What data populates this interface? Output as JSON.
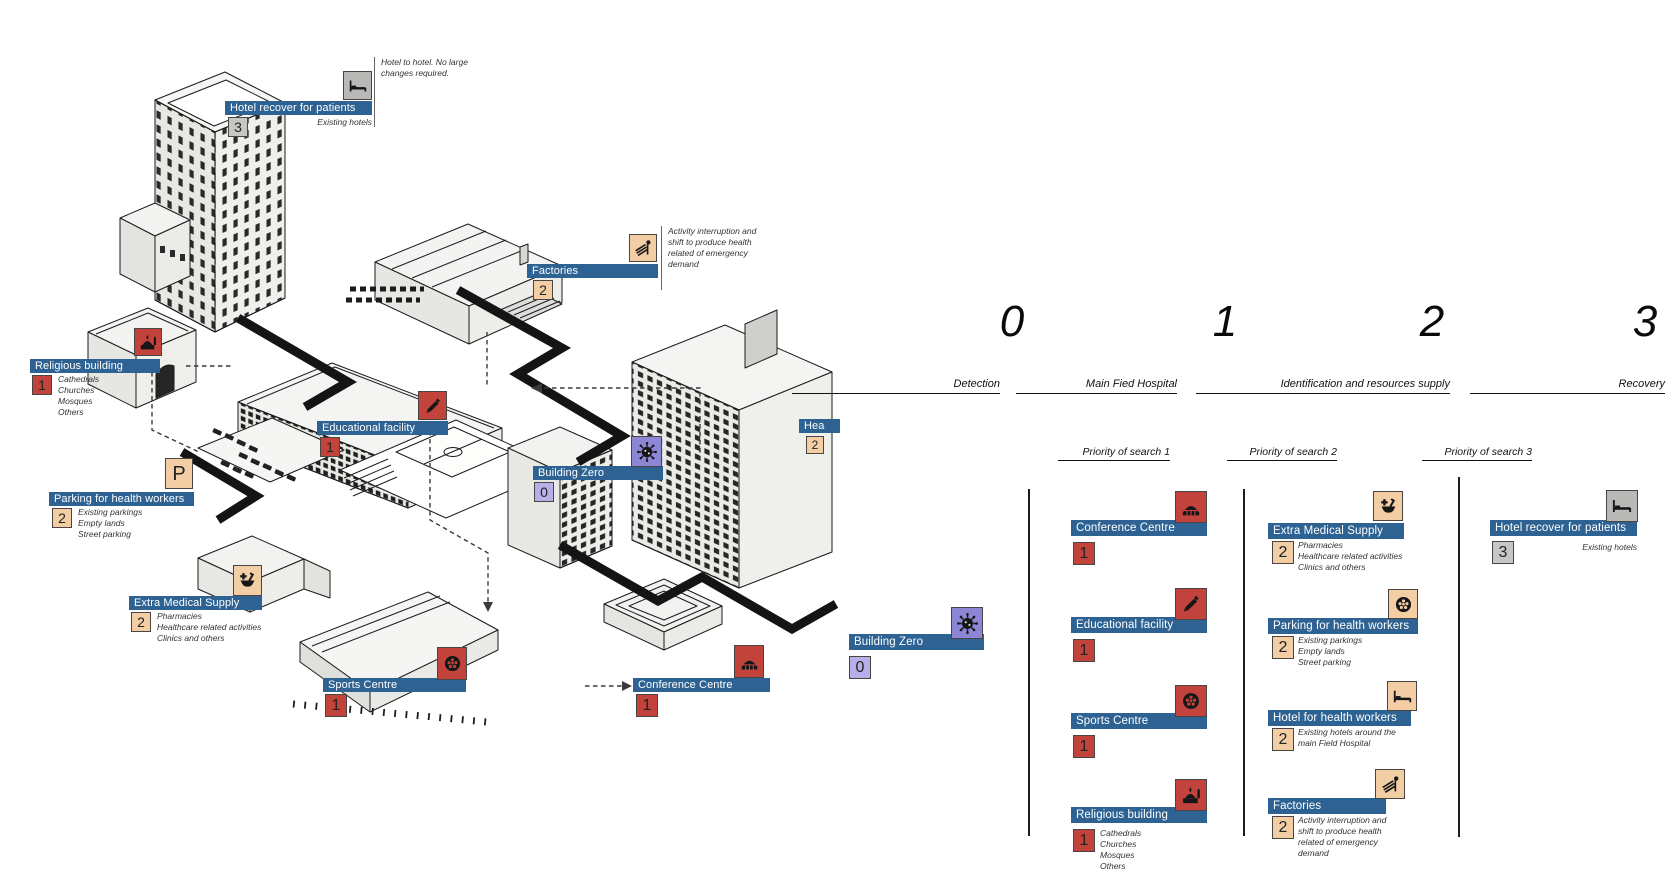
{
  "colors": {
    "bar_blue": "#2d6292",
    "red": "#c2423c",
    "tan": "#f3cda4",
    "purple": "#8d85d6",
    "purple_light": "#b7b0e8",
    "gray": "#b9b9b7"
  },
  "map": {
    "labels": [
      {
        "label": "Hotel recover for patients",
        "badge": "3",
        "icon": "bed-icon",
        "note": "Hotel to hotel. No large changes required.",
        "sub": [
          "Existing hotels"
        ]
      },
      {
        "label": "Factories",
        "badge": "2",
        "icon": "factory-icon",
        "note": "Activity interruption and shift to produce health related  of emergency demand"
      },
      {
        "label": "Religious building",
        "badge": "1",
        "icon": "religious-icon",
        "sub": [
          "Cathedrals",
          "Churches",
          "Mosques",
          "Others"
        ]
      },
      {
        "label": "Educational facility",
        "badge": "1",
        "icon": "education-icon"
      },
      {
        "label": "Building Zero",
        "badge": "0",
        "icon": "virus-icon"
      },
      {
        "label": "Parking for health workers",
        "badge": "2",
        "icon": "parking-icon",
        "icon_letter": "P",
        "sub": [
          "Existing parkings",
          "Empty lands",
          "Street parking"
        ]
      },
      {
        "label": "Extra Medical Supply",
        "badge": "2",
        "icon": "pharmacy-icon",
        "sub": [
          "Pharmacies",
          "Healthcare related activities",
          "Clinics and others"
        ]
      },
      {
        "label": "Sports Centre",
        "badge": "1",
        "icon": "ball-icon"
      },
      {
        "label": "Conference Centre",
        "badge": "1",
        "icon": "conference-icon"
      },
      {
        "label": "Hea",
        "badge": "2"
      }
    ]
  },
  "timeline": {
    "phases": [
      {
        "number": "0",
        "name": "Detection"
      },
      {
        "number": "1",
        "name": "Main Fied Hospital"
      },
      {
        "number": "2",
        "name": "Identification and resources supply"
      },
      {
        "number": "3",
        "name": "Recovery"
      }
    ],
    "priorities": [
      "Priority of search 1",
      "Priority of search 2",
      "Priority of search 3"
    ],
    "phase0": {
      "label": "Building Zero",
      "badge": "0"
    },
    "col1": [
      {
        "label": "Conference Centre",
        "badge": "1"
      },
      {
        "label": "Educational facility",
        "badge": "1"
      },
      {
        "label": "Sports Centre",
        "badge": "1"
      },
      {
        "label": "Religious building",
        "badge": "1",
        "sub": [
          "Cathedrals",
          "Churches",
          "Mosques",
          "Others"
        ]
      }
    ],
    "col2": [
      {
        "label": "Extra Medical Supply",
        "badge": "2",
        "sub": [
          "Pharmacies",
          "Healthcare related activities",
          "Clinics and others"
        ]
      },
      {
        "label": "Parking for health workers",
        "badge": "2",
        "sub": [
          "Existing parkings",
          "Empty lands",
          "Street parking"
        ]
      },
      {
        "label": "Hotel for health workers",
        "badge": "2",
        "note": "Existing hotels around the main Field Hospital"
      },
      {
        "label": "Factories",
        "badge": "2",
        "note": "Activity interruption and shift to produce health related  of emergency demand"
      }
    ],
    "col3": [
      {
        "label": "Hotel recover for patients",
        "badge": "3",
        "note": "Existing hotels"
      }
    ]
  }
}
